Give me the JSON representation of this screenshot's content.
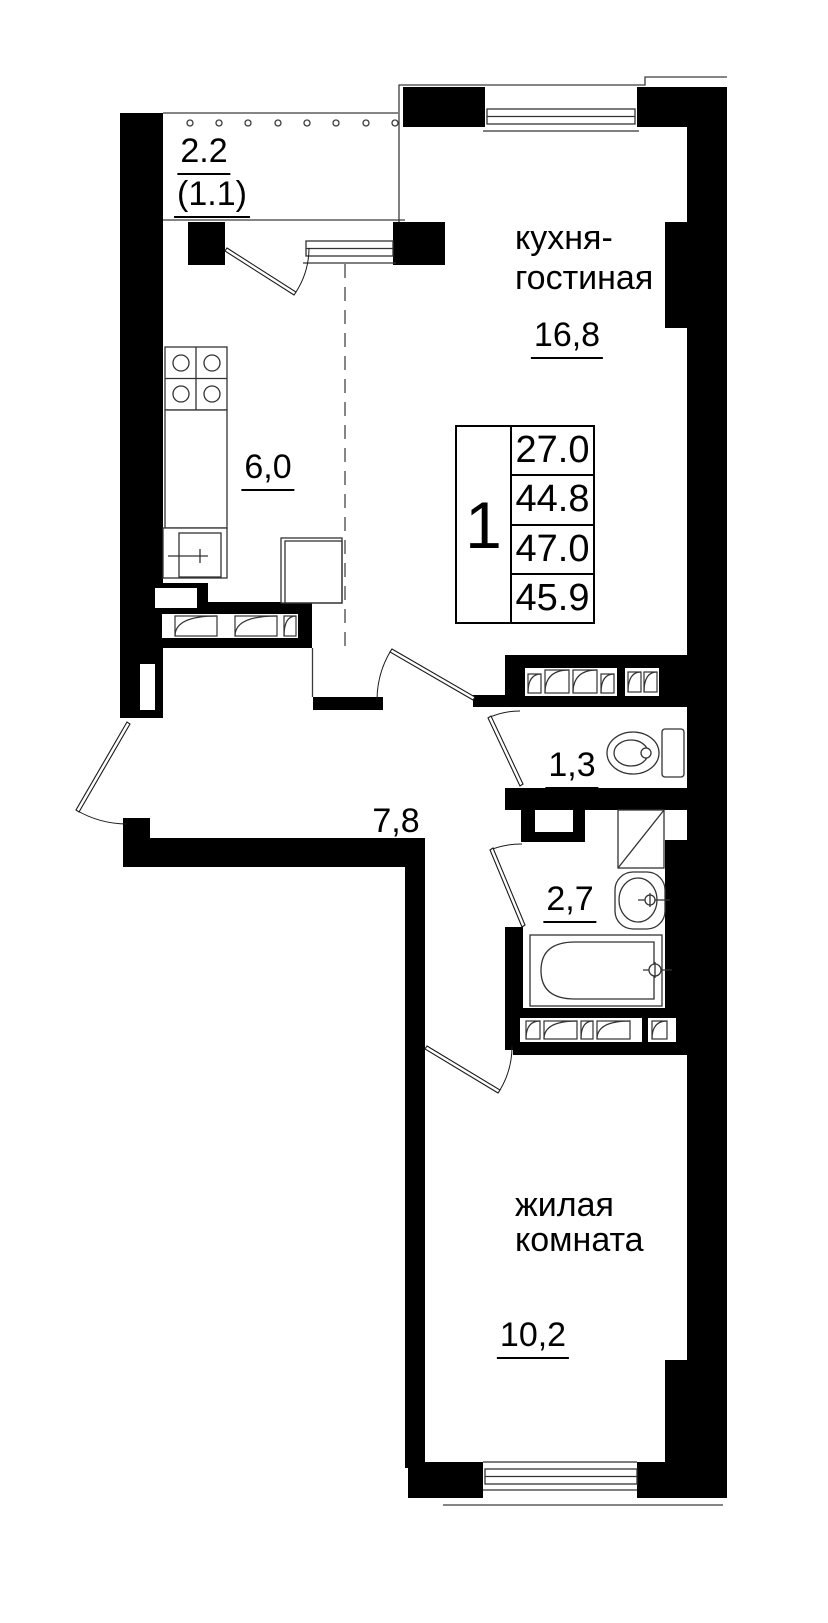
{
  "plan": {
    "balcony": {
      "area": "2.2",
      "area_secondary": "(1.1)"
    },
    "kitchen_living": {
      "name_line1": "кухня-",
      "name_line2": "гостиная",
      "area": "16,8"
    },
    "kitchen_zone": {
      "area": "6,0"
    },
    "hallway": {
      "area": "7,8"
    },
    "wc": {
      "area": "1,3"
    },
    "bathroom": {
      "area": "2,7"
    },
    "living_room": {
      "name_line1": "жилая",
      "name_line2": "комната",
      "area": "10,2"
    },
    "info_table": {
      "rooms_count": "1",
      "values": [
        "27.0",
        "44.8",
        "47.0",
        "45.9"
      ]
    },
    "fixtures": [
      "stove-icon",
      "kitchen-sink-icon",
      "fridge-icon",
      "toilet-icon",
      "shower-icon",
      "washbasin-icon",
      "bathtub-icon",
      "vent-shaft-icon",
      "balcony-railing",
      "entrance-door",
      "window-icon"
    ],
    "colors": {
      "walls": "#000000",
      "lines": "#333333",
      "background": "#ffffff"
    }
  }
}
